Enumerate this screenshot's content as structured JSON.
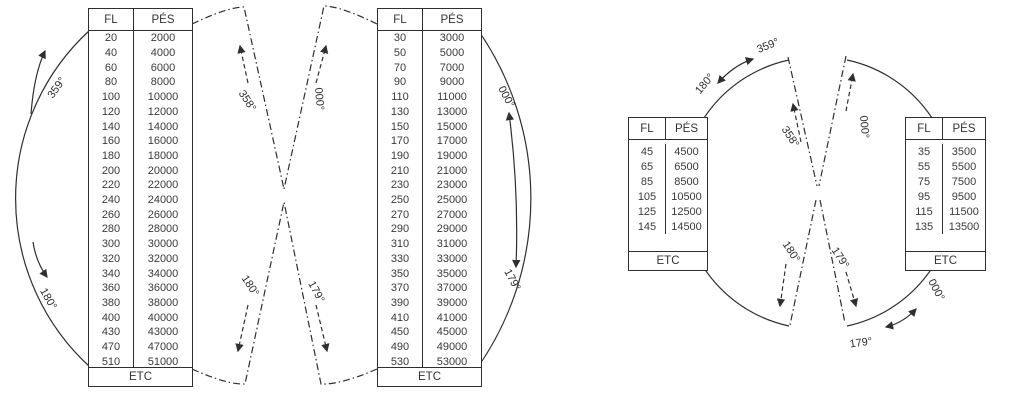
{
  "left_diagram": {
    "table_even": {
      "headers": [
        "FL",
        "PÉS"
      ],
      "rows": [
        [
          "20",
          "2000"
        ],
        [
          "40",
          "4000"
        ],
        [
          "60",
          "6000"
        ],
        [
          "80",
          "8000"
        ],
        [
          "100",
          "10000"
        ],
        [
          "120",
          "12000"
        ],
        [
          "140",
          "14000"
        ],
        [
          "160",
          "16000"
        ],
        [
          "180",
          "18000"
        ],
        [
          "200",
          "20000"
        ],
        [
          "220",
          "22000"
        ],
        [
          "240",
          "24000"
        ],
        [
          "260",
          "26000"
        ],
        [
          "280",
          "28000"
        ],
        [
          "300",
          "30000"
        ],
        [
          "320",
          "32000"
        ],
        [
          "340",
          "34000"
        ],
        [
          "360",
          "36000"
        ],
        [
          "380",
          "38000"
        ],
        [
          "400",
          "40000"
        ],
        [
          "430",
          "43000"
        ],
        [
          "470",
          "47000"
        ],
        [
          "510",
          "51000"
        ]
      ],
      "footer": "ETC"
    },
    "table_odd": {
      "headers": [
        "FL",
        "PÉS"
      ],
      "rows": [
        [
          "30",
          "3000"
        ],
        [
          "50",
          "5000"
        ],
        [
          "70",
          "7000"
        ],
        [
          "90",
          "9000"
        ],
        [
          "110",
          "11000"
        ],
        [
          "130",
          "13000"
        ],
        [
          "150",
          "15000"
        ],
        [
          "170",
          "17000"
        ],
        [
          "190",
          "19000"
        ],
        [
          "210",
          "21000"
        ],
        [
          "230",
          "23000"
        ],
        [
          "250",
          "25000"
        ],
        [
          "270",
          "27000"
        ],
        [
          "290",
          "29000"
        ],
        [
          "310",
          "31000"
        ],
        [
          "330",
          "33000"
        ],
        [
          "350",
          "35000"
        ],
        [
          "370",
          "37000"
        ],
        [
          "390",
          "39000"
        ],
        [
          "410",
          "41000"
        ],
        [
          "450",
          "45000"
        ],
        [
          "490",
          "49000"
        ],
        [
          "530",
          "53000"
        ]
      ],
      "footer": "ETC"
    },
    "labels": {
      "outer_top_left": "359°",
      "outer_bottom_left": "180°",
      "inner_top_left": "358°",
      "inner_top_right": "000°",
      "inner_bottom_left": "180°",
      "inner_bottom_right": "179°",
      "outer_top_right": "000°",
      "outer_bottom_right": "179°"
    }
  },
  "right_diagram": {
    "table_even_plus_500": {
      "headers": [
        "FL",
        "PÉS"
      ],
      "rows": [
        [
          "45",
          "4500"
        ],
        [
          "65",
          "6500"
        ],
        [
          "85",
          "8500"
        ],
        [
          "105",
          "10500"
        ],
        [
          "125",
          "12500"
        ],
        [
          "145",
          "14500"
        ]
      ],
      "footer": "ETC"
    },
    "table_odd_plus_500": {
      "headers": [
        "FL",
        "PÉS"
      ],
      "rows": [
        [
          "35",
          "3500"
        ],
        [
          "55",
          "5500"
        ],
        [
          "75",
          "7500"
        ],
        [
          "95",
          "9500"
        ],
        [
          "115",
          "11500"
        ],
        [
          "135",
          "13500"
        ]
      ],
      "footer": "ETC"
    },
    "labels": {
      "arc_range_start": "180°",
      "arc_range_end": "359°",
      "inner_top_left": "358°",
      "inner_top_right": "000°",
      "inner_bottom_left": "180°",
      "inner_bottom_right": "179°",
      "arc_range2_end": "000°",
      "arc_range2_start": "179°"
    }
  },
  "colors": {
    "ink": "#2f2f2f"
  }
}
